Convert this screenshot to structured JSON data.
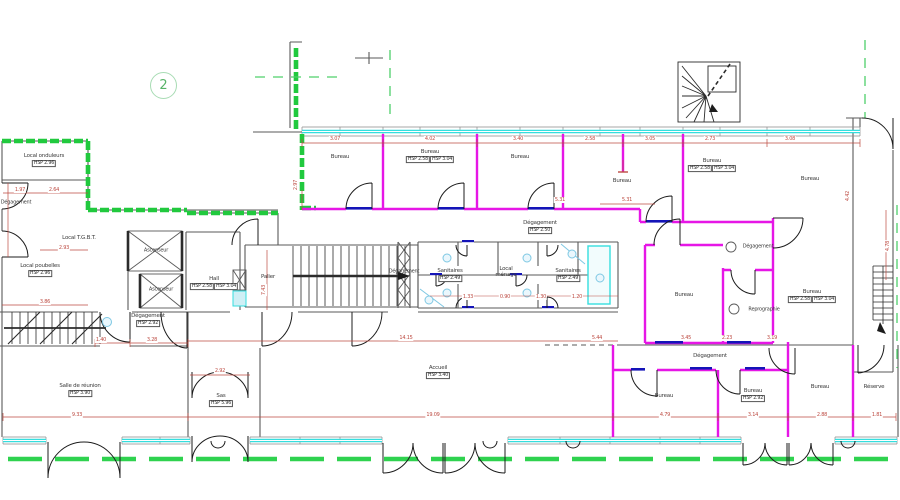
{
  "sheet": {
    "number": "2"
  },
  "colors": {
    "wall_green": "#21c93e",
    "wall_magenta": "#e616e6",
    "window_cyan": "#35dede",
    "dimension_red": "#bd4b42",
    "door_sill_blue": "#1414b8",
    "fixture_blue": "#7ec8e3",
    "outline_gray": "#5a5a5a",
    "ground_dash_green": "#2fd24f",
    "sheet_number_green": "#58b368"
  },
  "rooms": [
    {
      "id": "local-onduleurs",
      "label": "Local onduleurs",
      "hsp": [
        "HSP  2.96"
      ],
      "x": 44,
      "y": 160
    },
    {
      "id": "degagement-left",
      "label": "Dégagement",
      "x": 16,
      "y": 203,
      "small": true
    },
    {
      "id": "local-tgbt",
      "label": "Local T.G.B.T.",
      "x": 79,
      "y": 238
    },
    {
      "id": "local-poubelles",
      "label": "Local poubelles",
      "hsp": [
        "HSP  2.96"
      ],
      "x": 40,
      "y": 270
    },
    {
      "id": "ascenseur-1",
      "label": "Ascenseur",
      "x": 156,
      "y": 251,
      "small": true
    },
    {
      "id": "ascenseur-2",
      "label": "Ascenseur",
      "x": 161,
      "y": 290,
      "small": true
    },
    {
      "id": "hall",
      "label": "Hall",
      "hsp": [
        "HSP  2.58",
        "HSP  3.04"
      ],
      "x": 214,
      "y": 283
    },
    {
      "id": "degagement-hall",
      "label": "Dégagement",
      "hsp": [
        "HSP  2.92"
      ],
      "x": 148,
      "y": 320
    },
    {
      "id": "palier",
      "label": "Palier",
      "x": 268,
      "y": 277
    },
    {
      "id": "degagement-corridor",
      "label": "Dégagement",
      "hsp": [
        "HSP  2.50"
      ],
      "x": 540,
      "y": 227
    },
    {
      "id": "degagement-wc",
      "label": "Dégagement",
      "x": 404,
      "y": 272,
      "small": true
    },
    {
      "id": "sanitaires-left",
      "label": "Sanitaires",
      "hsp": [
        "HSP  2.49"
      ],
      "x": 450,
      "y": 275
    },
    {
      "id": "local-menage",
      "label": "Local ménage",
      "x": 506,
      "y": 272,
      "w": 30,
      "wrap": true
    },
    {
      "id": "sanitaires-right",
      "label": "Sanitaires",
      "hsp": [
        "HSP  2.49"
      ],
      "x": 568,
      "y": 275
    },
    {
      "id": "bureau-top-1",
      "label": "Bureau",
      "x": 340,
      "y": 157
    },
    {
      "id": "bureau-top-2",
      "label": "Bureau",
      "hsp": [
        "HSP  2.58",
        "HSP  3.04"
      ],
      "x": 430,
      "y": 156
    },
    {
      "id": "bureau-top-3",
      "label": "Bureau",
      "x": 520,
      "y": 157
    },
    {
      "id": "bureau-top-4",
      "label": "Bureau",
      "x": 622,
      "y": 181
    },
    {
      "id": "bureau-top-5",
      "label": "Bureau",
      "hsp": [
        "HSP  2.58",
        "HSP  3.04"
      ],
      "x": 712,
      "y": 165
    },
    {
      "id": "bureau-top-6",
      "label": "Bureau",
      "x": 810,
      "y": 179
    },
    {
      "id": "degagement-right",
      "label": "Dégagement",
      "x": 758,
      "y": 247,
      "small": true
    },
    {
      "id": "bureau-mid-1",
      "label": "Bureau",
      "x": 684,
      "y": 295
    },
    {
      "id": "reprographie",
      "label": "Reprographie",
      "x": 764,
      "y": 310,
      "small": true
    },
    {
      "id": "bureau-mid-2",
      "label": "Bureau",
      "hsp": [
        "HSP  2.58",
        "HSP  3.04"
      ],
      "x": 812,
      "y": 296
    },
    {
      "id": "degagement-bottom",
      "label": "Dégagement",
      "x": 710,
      "y": 356
    },
    {
      "id": "bureau-bottom-1",
      "label": "Bureau",
      "x": 664,
      "y": 396
    },
    {
      "id": "bureau-bottom-2",
      "label": "Bureau",
      "hsp": [
        "HSP  2.92"
      ],
      "x": 753,
      "y": 395
    },
    {
      "id": "bureau-bottom-3",
      "label": "Bureau",
      "x": 820,
      "y": 387
    },
    {
      "id": "reserve",
      "label": "Réserve",
      "x": 874,
      "y": 387
    },
    {
      "id": "salle-de-reunion",
      "label": "Salle de réunion",
      "hsp": [
        "HSP  3.90"
      ],
      "x": 80,
      "y": 390
    },
    {
      "id": "sas",
      "label": "Sas",
      "hsp": [
        "HSP  5.96"
      ],
      "x": 221,
      "y": 400
    },
    {
      "id": "accueil",
      "label": "Accueil",
      "hsp": [
        "HSP  3.40"
      ],
      "x": 438,
      "y": 372
    }
  ],
  "dims": [
    {
      "t": "3.07",
      "x": 335,
      "y": 139
    },
    {
      "t": "4.02",
      "x": 430,
      "y": 139
    },
    {
      "t": "3.40",
      "x": 518,
      "y": 139
    },
    {
      "t": "2.58",
      "x": 590,
      "y": 139
    },
    {
      "t": "3.05",
      "x": 650,
      "y": 139
    },
    {
      "t": "2.73",
      "x": 710,
      "y": 139
    },
    {
      "t": "3.08",
      "x": 790,
      "y": 139
    },
    {
      "t": "5.31",
      "x": 627,
      "y": 200
    },
    {
      "t": "2.97",
      "x": 296,
      "y": 185,
      "v": true
    },
    {
      "t": "1.97",
      "x": 20,
      "y": 190
    },
    {
      "t": "2.64",
      "x": 54,
      "y": 190
    },
    {
      "t": "2.93",
      "x": 64,
      "y": 248
    },
    {
      "t": "3.86",
      "x": 45,
      "y": 302
    },
    {
      "t": "1.40",
      "x": 101,
      "y": 340
    },
    {
      "t": "3.28",
      "x": 152,
      "y": 340
    },
    {
      "t": "7.43",
      "x": 264,
      "y": 290,
      "v": true
    },
    {
      "t": "14.15",
      "x": 406,
      "y": 338
    },
    {
      "t": "5.44",
      "x": 597,
      "y": 338
    },
    {
      "t": "3.45",
      "x": 686,
      "y": 338
    },
    {
      "t": "2.23",
      "x": 727,
      "y": 338
    },
    {
      "t": "3.19",
      "x": 772,
      "y": 338
    },
    {
      "t": "2.92",
      "x": 220,
      "y": 371
    },
    {
      "t": "9.33",
      "x": 77,
      "y": 415
    },
    {
      "t": "19.09",
      "x": 433,
      "y": 415
    },
    {
      "t": "4.79",
      "x": 665,
      "y": 415
    },
    {
      "t": "3.14",
      "x": 753,
      "y": 415
    },
    {
      "t": "2.88",
      "x": 822,
      "y": 415
    },
    {
      "t": "1.81",
      "x": 877,
      "y": 415
    },
    {
      "t": "1.33",
      "x": 468,
      "y": 297
    },
    {
      "t": "0.90",
      "x": 505,
      "y": 297
    },
    {
      "t": "1.30",
      "x": 541,
      "y": 297
    },
    {
      "t": "1.20",
      "x": 577,
      "y": 297
    },
    {
      "t": "4.42",
      "x": 848,
      "y": 196,
      "v": true
    },
    {
      "t": "4.78",
      "x": 888,
      "y": 246,
      "v": true
    },
    {
      "t": "5.31",
      "x": 560,
      "y": 200
    }
  ]
}
